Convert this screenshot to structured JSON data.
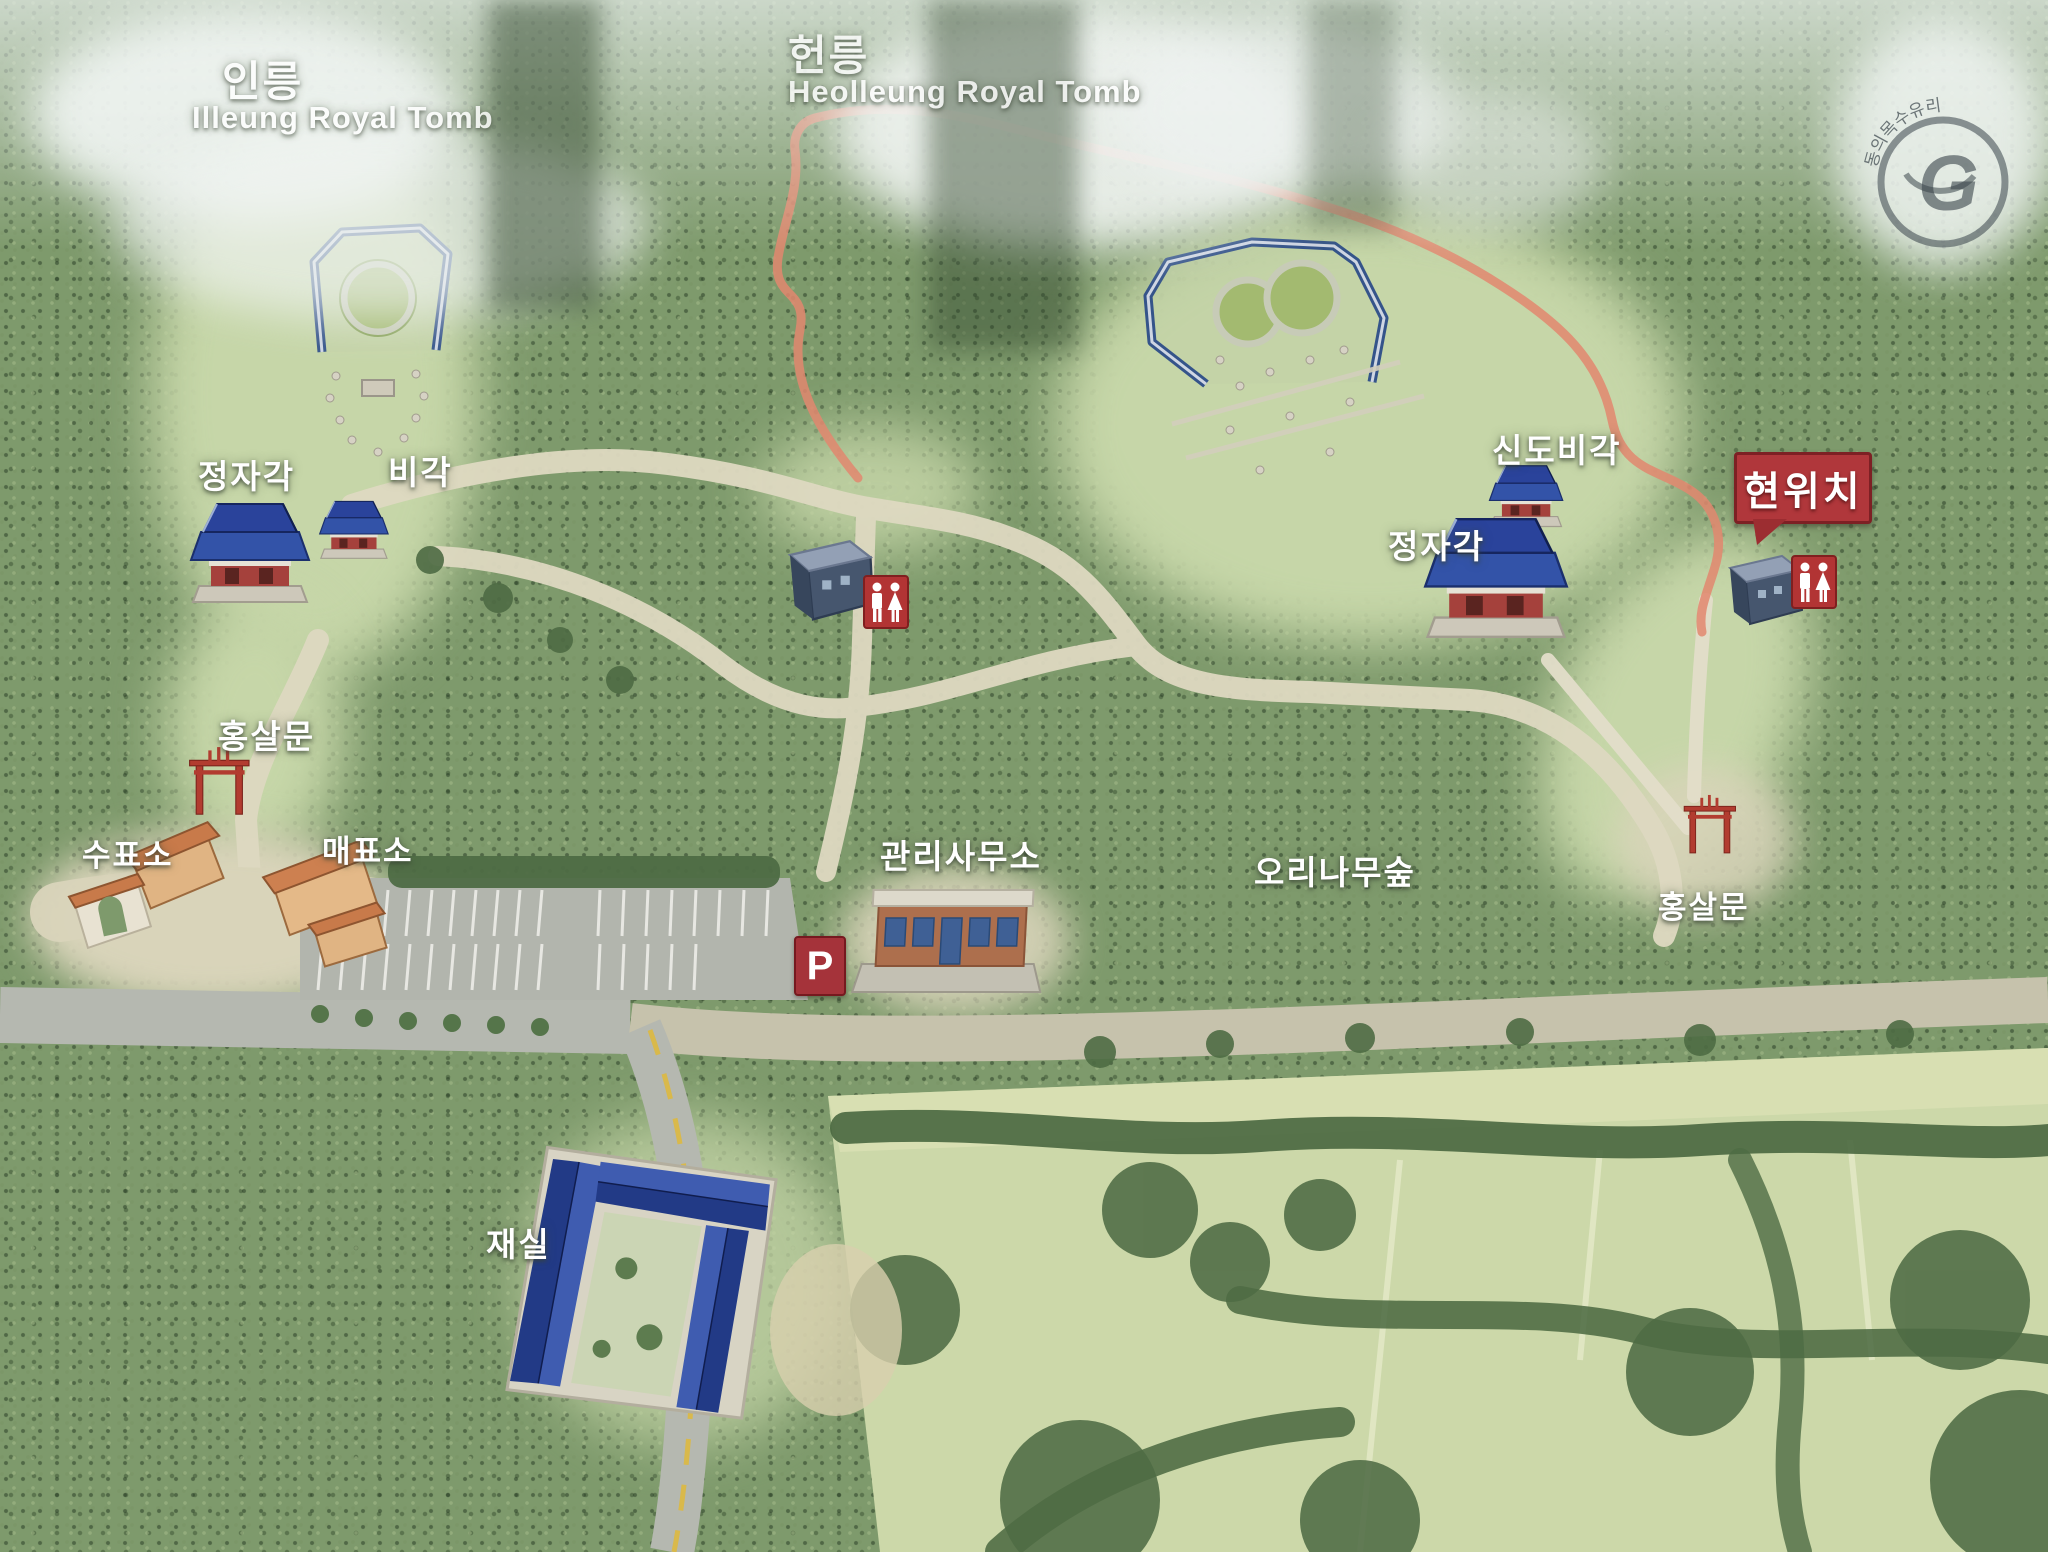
{
  "titles": {
    "left_ko": "인릉",
    "left_en": "Illeung Royal Tomb",
    "right_ko": "헌릉",
    "right_en": "Heolleung Royal Tomb"
  },
  "labels": {
    "jeongjagak_left": "정자각",
    "bigak": "비각",
    "hongsalmun_left": "홍살문",
    "supyoso": "수표소",
    "maepyoso": "매표소",
    "office": "관리사무소",
    "alder_forest": "오리나무숲",
    "sindobigak": "신도비각",
    "jeongjagak_right": "정자각",
    "hongsalmun_right": "홍살문",
    "jaesil": "재실"
  },
  "markers": {
    "current_location": "현위치",
    "parking": "P"
  },
  "icons": {
    "restroom": "male-female-restroom-pictogram",
    "parking": "parking-p-sign"
  },
  "stamp": {
    "ring_text": "동의목수유리",
    "monogram": "G"
  },
  "colors": {
    "current_location_red": "#b0373b",
    "parking_red": "#a5333a",
    "restroom_red": "#b23434",
    "trail_orange": "#e2876e",
    "roof_blue": "#2e4a9e",
    "gate_red": "#b23c30",
    "forest_green": "#7e9a6c",
    "clearing_green": "#c6d6a8",
    "path_beige": "#ded9c1",
    "road_gray": "#b5b8b0"
  }
}
